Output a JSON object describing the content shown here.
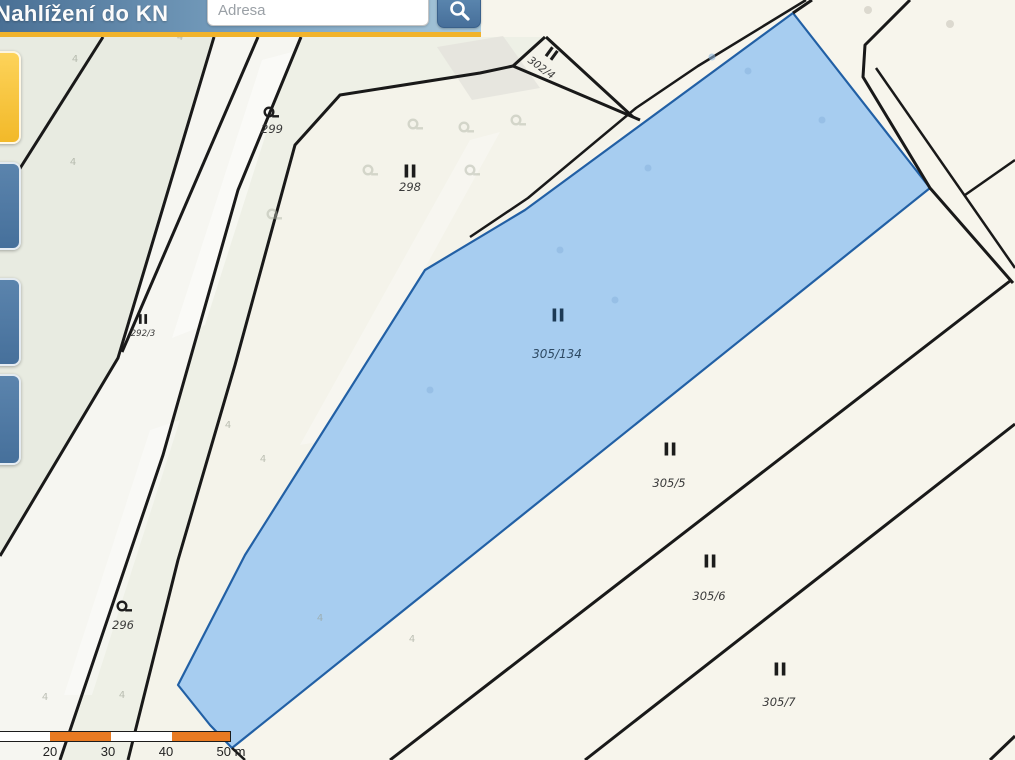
{
  "header": {
    "title": "Nahlížení do KN",
    "search": {
      "placeholder": "Adresa"
    },
    "search_button_icon": "magnifier",
    "colors": {
      "bar_left": "#4a7095",
      "bar_right": "#a9c8da",
      "accent_underline": "#f1b32b",
      "button": "#4d7aa6"
    }
  },
  "side_toolbar": {
    "buttons": [
      {
        "id": "tool-highlight",
        "color": "#f4c12f"
      },
      {
        "id": "tool-blue-1",
        "color": "#4d7aa5"
      },
      {
        "id": "tool-blue-2",
        "color": "#4d7aa5"
      },
      {
        "id": "tool-blue-3",
        "color": "#4d7aa5"
      }
    ]
  },
  "map": {
    "line_color": "#191919",
    "selected_parcel": {
      "parcel_index": 5,
      "fill": "#a7cdf0",
      "outline": "#2260a5"
    },
    "parcels": [
      {
        "number": "299",
        "symbol": "garden"
      },
      {
        "number": "298",
        "symbol": "grass-II"
      },
      {
        "number": "302/4",
        "symbol": "grass-II"
      },
      {
        "number": "292/3",
        "symbol": "grass-II"
      },
      {
        "number": "296",
        "symbol": "garden"
      },
      {
        "number": "305/134",
        "symbol": "grass-II"
      },
      {
        "number": "305/5",
        "symbol": "grass-II"
      },
      {
        "number": "305/6",
        "symbol": "grass-II"
      },
      {
        "number": "305/7",
        "symbol": "grass-II"
      }
    ]
  },
  "scalebar": {
    "labels": [
      "20",
      "30",
      "40",
      "50 m"
    ],
    "orange": "#e87a22"
  }
}
